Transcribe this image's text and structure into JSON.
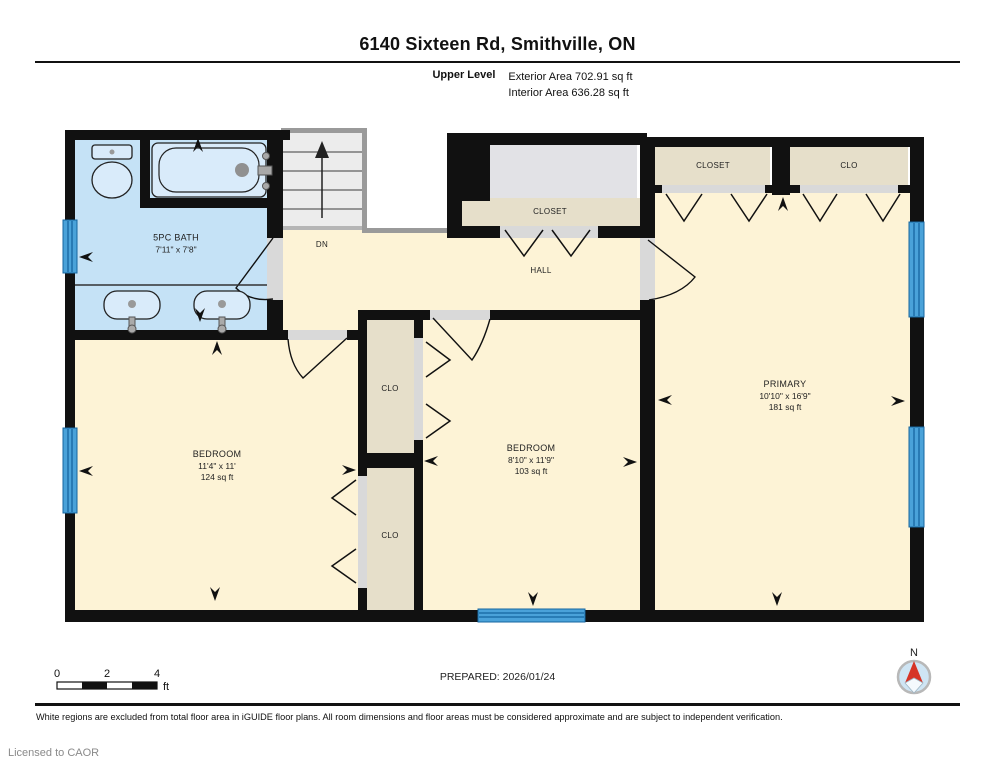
{
  "header": {
    "title": "6140 Sixteen Rd, Smithville, ON",
    "level_label": "Upper Level",
    "exterior_area": "Exterior Area 702.91 sq ft",
    "interior_area": "Interior Area 636.28 sq ft"
  },
  "plan": {
    "rooms": {
      "bath": {
        "name": "5PC BATH",
        "dims": "7'11\" x 7'8\""
      },
      "bedroom_left": {
        "name": "BEDROOM",
        "dims": "11'4\" x 11'",
        "area": "124 sq ft"
      },
      "bedroom_middle": {
        "name": "BEDROOM",
        "dims": "8'10\" x 11'9\"",
        "area": "103 sq ft"
      },
      "primary": {
        "name": "PRIMARY",
        "dims": "10'10\" x 16'9\"",
        "area": "181 sq ft"
      },
      "hall": {
        "name": "HALL"
      },
      "stairs": {
        "label": "DN"
      },
      "hall_closet": {
        "name": "CLOSET"
      },
      "primary_closet_left": {
        "name": "CLOSET"
      },
      "primary_closet_right": {
        "name": "CLO"
      },
      "clo_upper": {
        "name": "CLO"
      },
      "clo_lower": {
        "name": "CLO"
      }
    },
    "colors": {
      "floor": "#fdf3d6",
      "bath": "#c5e2f6",
      "closet": "#e6dfca",
      "gray_area": "#e2e2e6",
      "wall": "#111111",
      "window_fill": "#4aa2d9",
      "window_line": "#1565a0",
      "compass_north": "#d63426"
    }
  },
  "footer": {
    "prepared": "PREPARED: 2026/01/24",
    "disclaimer": "White regions are excluded from total floor area in iGUIDE floor plans. All room dimensions and floor areas must be considered approximate and are subject to independent verification.",
    "licensed": "Licensed to CAOR",
    "scale": {
      "ticks": [
        "0",
        "2",
        "4"
      ],
      "unit": "ft"
    },
    "compass": {
      "label": "N"
    }
  }
}
